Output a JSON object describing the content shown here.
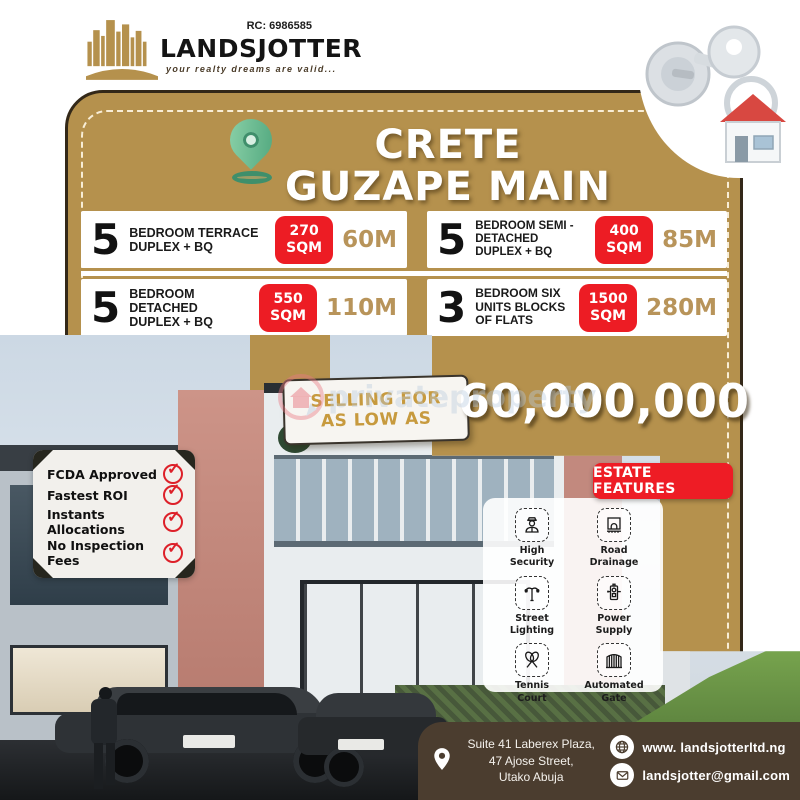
{
  "brand": {
    "rc": "RC: 6986585",
    "name": "LANDSJOTTER",
    "tagline": "your realty dreams are valid..."
  },
  "title": {
    "line1": "CRETE",
    "line2": "GUZAPE MAIN"
  },
  "listings": [
    {
      "number": "5",
      "description": "BEDROOM TERRACE DUPLEX + BQ",
      "sqm": "270",
      "sqm_unit": "SQM",
      "price": "60M"
    },
    {
      "number": "5",
      "description": "BEDROOM SEMI - DETACHED DUPLEX + BQ",
      "sqm": "400",
      "sqm_unit": "SQM",
      "price": "85M"
    },
    {
      "number": "5",
      "description": "BEDROOM DETACHED DUPLEX + BQ",
      "sqm": "550",
      "sqm_unit": "SQM",
      "price": "110M"
    },
    {
      "number": "3",
      "description": "BEDROOM SIX UNITS BLOCKS OF FLATS",
      "sqm": "1500",
      "sqm_unit": "SQM",
      "price": "280M"
    }
  ],
  "offer": {
    "ribbon_line1": "SELLING FOR",
    "ribbon_line2": "AS LOW AS",
    "price": "60,000,000"
  },
  "watermark": {
    "text": "privateproperty"
  },
  "checklist": [
    "FCDA Approved",
    "Fastest ROI",
    "Instants Allocations",
    "No Inspection Fees"
  ],
  "features": {
    "heading": "ESTATE FEATURES",
    "items": [
      {
        "label1": "High",
        "label2": "Security"
      },
      {
        "label1": "Road",
        "label2": "Drainage"
      },
      {
        "label1": "Street",
        "label2": "Lighting"
      },
      {
        "label1": "Power",
        "label2": "Supply"
      },
      {
        "label1": "Tennis",
        "label2": "Court"
      },
      {
        "label1": "Automated",
        "label2": "Gate"
      }
    ]
  },
  "contact": {
    "address_line1": "Suite 41 Laberex Plaza,",
    "address_line2": "47 Ajose Street,",
    "address_line3": "Utako Abuja",
    "website": "www. landsjotterltd.ng",
    "email": "landsjotter@gmail.com"
  },
  "colors": {
    "gold": "#b5914d",
    "badge_red": "#ed1c24",
    "feature_red": "#ee1c25",
    "bar_brown": "#4b3d2f",
    "pin_green": "#6fbd94",
    "check_red": "#dd2029"
  }
}
